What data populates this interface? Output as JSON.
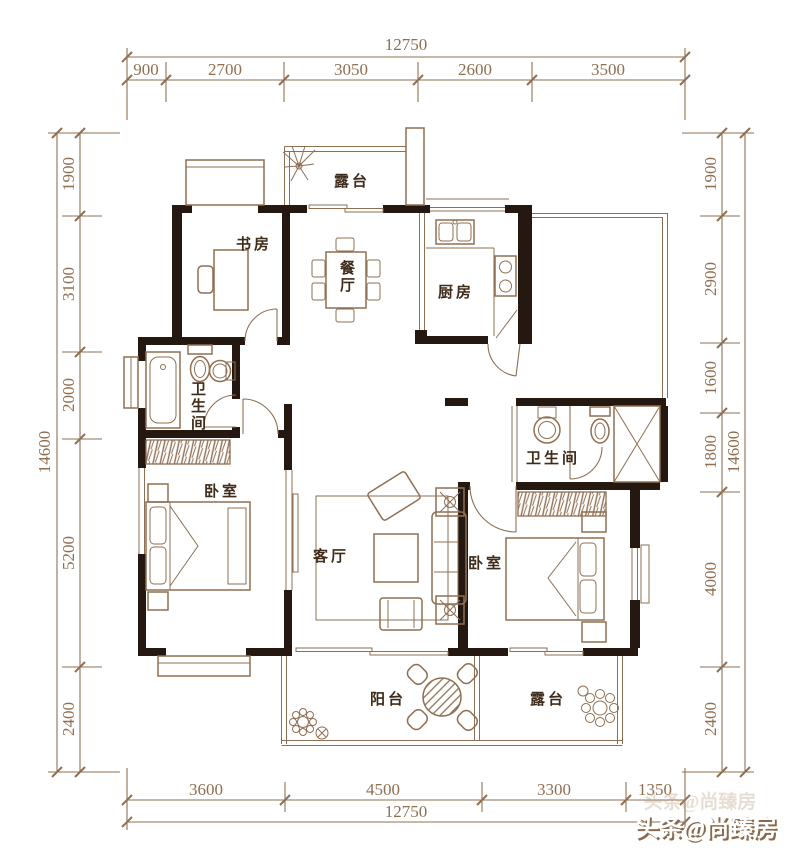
{
  "colors": {
    "background": "#ffffff",
    "line_brown": "#8f6f52",
    "wall_black": "#241811",
    "room_label": "#3f2c1b",
    "dimension_text": "#8f6f52",
    "watermark_fill": "#ffffff",
    "watermark_shadow": "#8a6a4e"
  },
  "dims": {
    "top": {
      "total": "12750",
      "segments": [
        "900",
        "2700",
        "3050",
        "2600",
        "3500"
      ]
    },
    "bottom": {
      "total": "12750",
      "segments": [
        "3600",
        "4500",
        "3300",
        "1350"
      ]
    },
    "left": {
      "total": "14600",
      "segments": [
        "1900",
        "3100",
        "2000",
        "5200",
        "2400"
      ]
    },
    "right": {
      "total": "14600",
      "segments": [
        "1900",
        "2900",
        "1600",
        "1800",
        "4000",
        "2400"
      ]
    }
  },
  "rooms": {
    "terrace_top": "露台",
    "study": "书房",
    "dining": "餐厅",
    "kitchen": "厨房",
    "bathroom_left": "卫生间",
    "bedroom_left": "卧室",
    "living_room": "客厅",
    "bathroom_right": "卫生间",
    "bedroom_right": "卧室",
    "balcony": "阳台",
    "terrace_bottom": "露台"
  },
  "watermark": {
    "text": "头条@尚臻房"
  }
}
